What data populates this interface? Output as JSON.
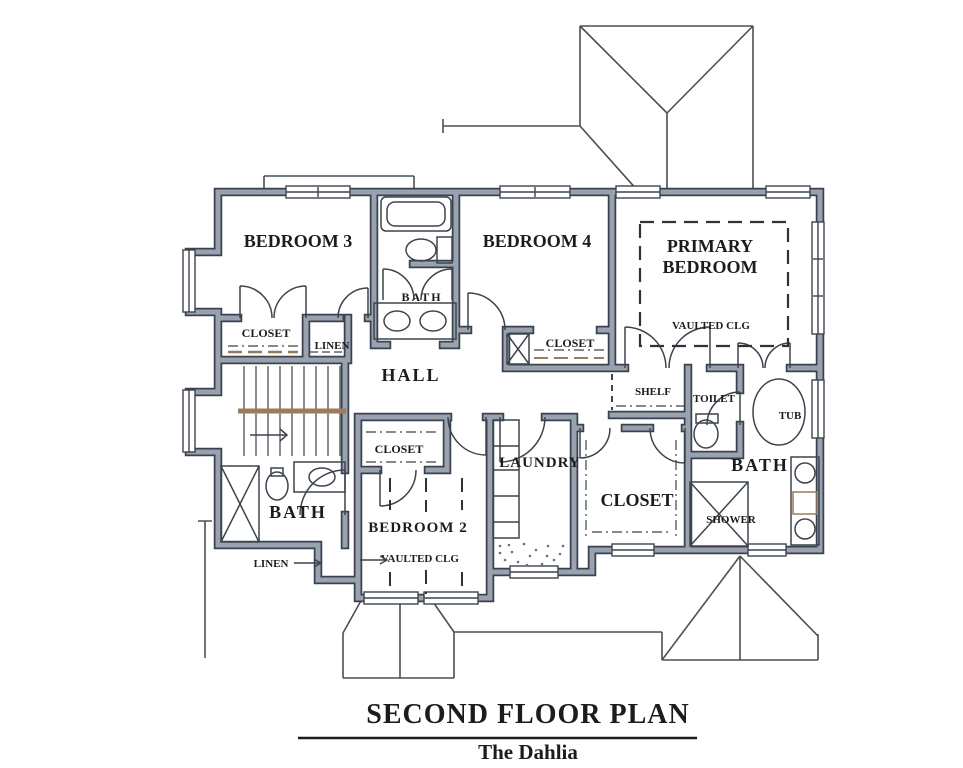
{
  "plan": {
    "labels": {
      "bedroom3": "BEDROOM 3",
      "bath_hall": "BATH",
      "bedroom4": "BEDROOM 4",
      "primary_line1": "PRIMARY",
      "primary_line2": "BEDROOM",
      "primary_vaulted": "VAULTED CLG",
      "closet_b3": "CLOSET",
      "linen_hall": "LINEN",
      "hall": "HALL",
      "closet_b4": "CLOSET",
      "shelf": "SHELF",
      "toilet": "TOILET",
      "tub": "TUB",
      "bath_primary": "BATH",
      "closet_walkin": "CLOSET",
      "shower": "SHOWER",
      "laundry": "LAUNDRY",
      "closet_b2": "CLOSET",
      "bedroom2": "BEDROOM 2",
      "bedroom2_vaulted": "VAULTED CLG",
      "bath_left": "BATH",
      "linen_left": "LINEN"
    },
    "title": "SECOND FLOOR PLAN",
    "subtitle": "The Dahlia",
    "colors": {
      "wall_fill": "#99a2ae",
      "wall_edge": "#39424e",
      "line": "#3d444d",
      "roof_line": "#4a5056",
      "wood": "#9c7b5c",
      "text": "#1c1c1c",
      "paper": "#ffffff"
    }
  }
}
